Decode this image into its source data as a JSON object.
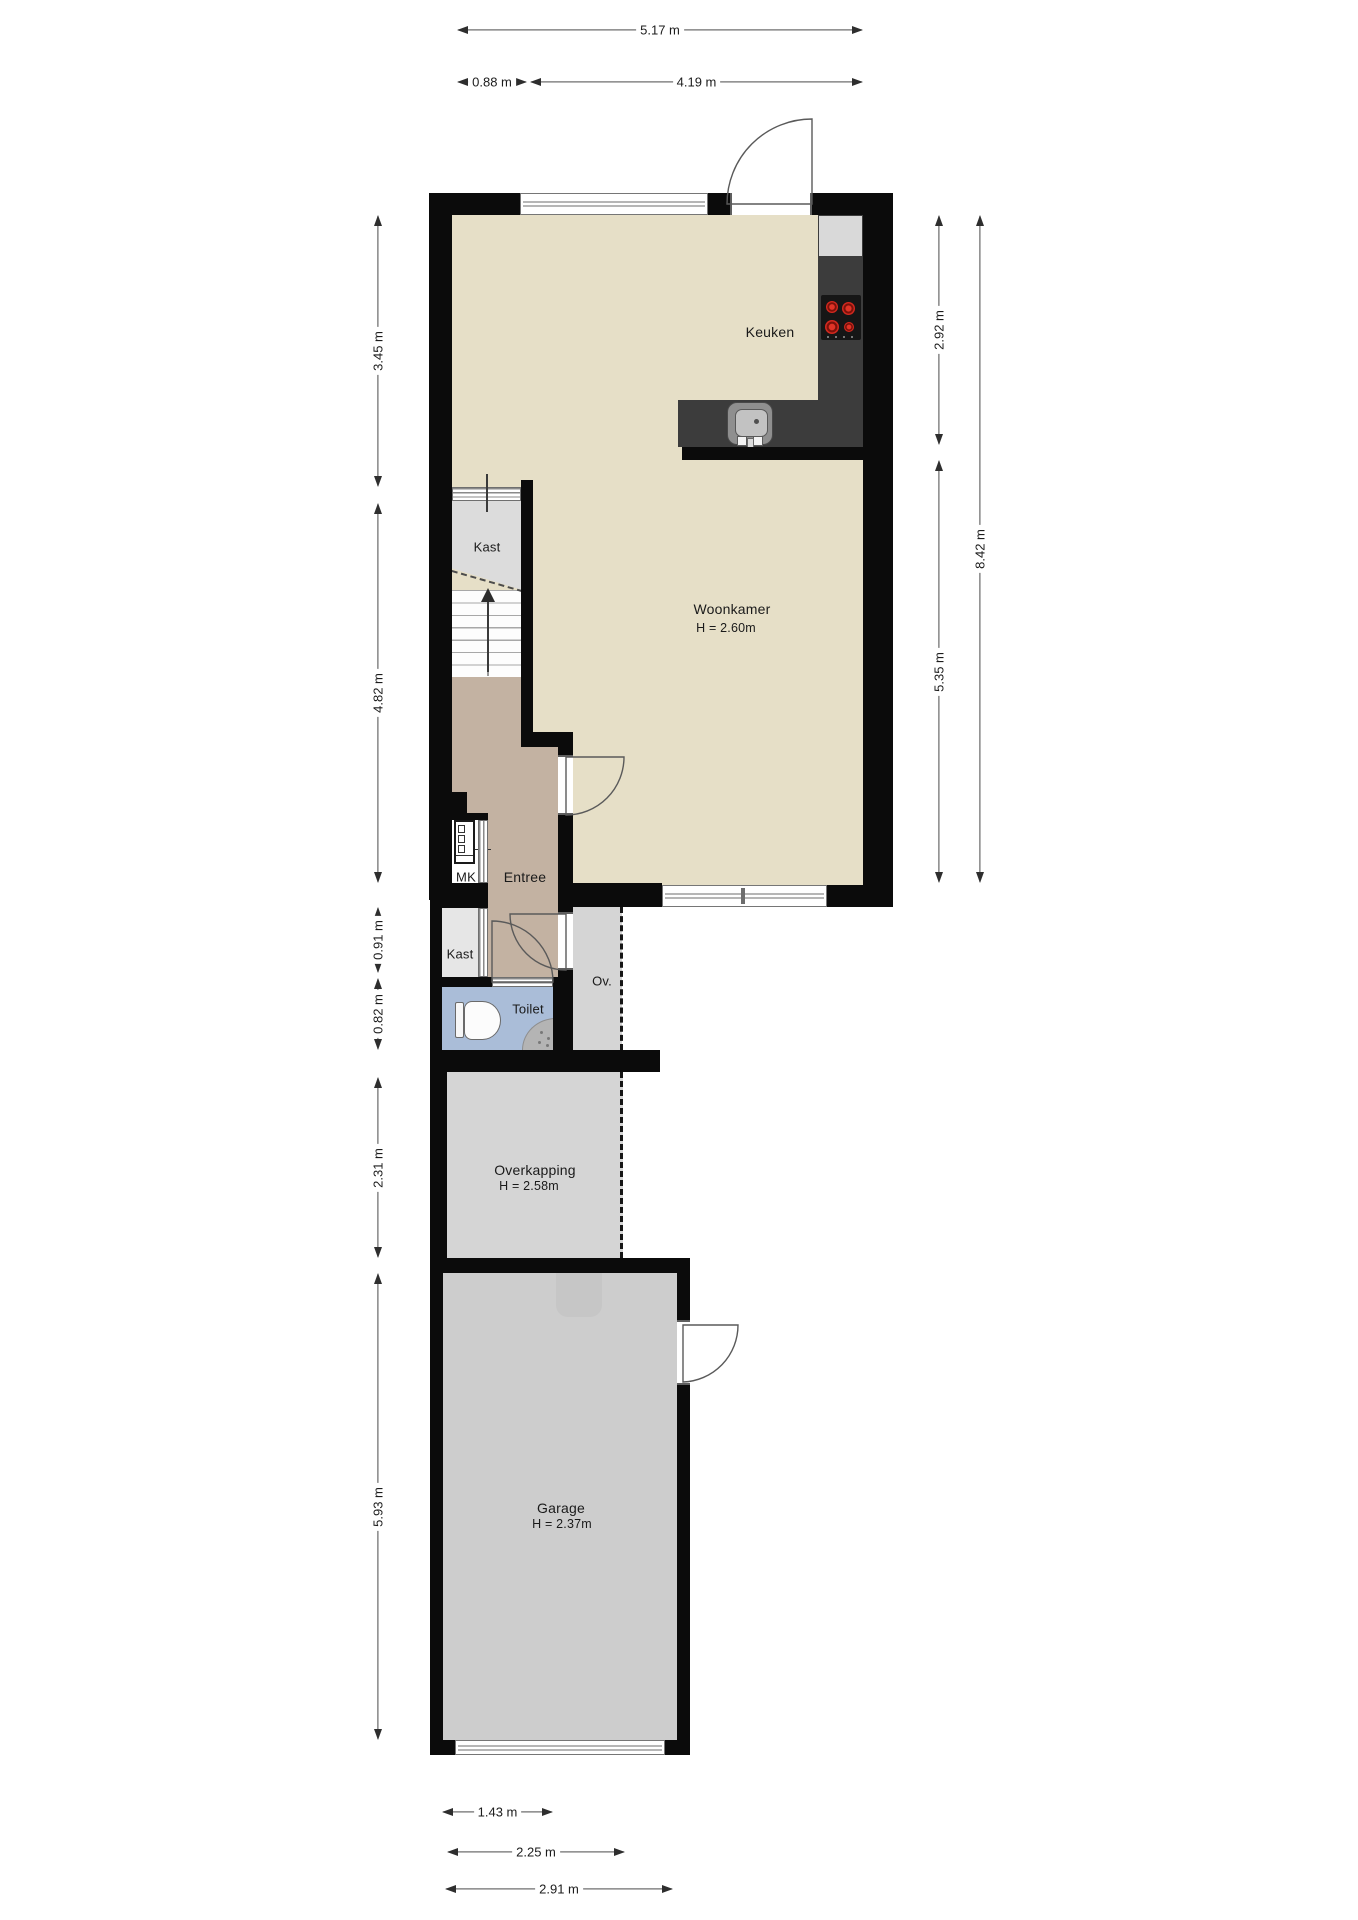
{
  "plan": {
    "type": "floor-plan",
    "language": "nl"
  },
  "rooms": {
    "keuken": {
      "label": "Keuken"
    },
    "woonkamer": {
      "label": "Woonkamer",
      "height_label": "H = 2.60m"
    },
    "kast_boven": {
      "label": "Kast"
    },
    "entree": {
      "label": "Entree"
    },
    "meterkast": {
      "label": "MK"
    },
    "kast_hal": {
      "label": "Kast"
    },
    "toilet": {
      "label": "Toilet"
    },
    "ov": {
      "label": "Ov."
    },
    "overkapping": {
      "label": "Overkapping",
      "height_label": "H = 2.58m"
    },
    "garage": {
      "label": "Garage",
      "height_label": "H = 2.37m"
    }
  },
  "dims": {
    "top": [
      {
        "label": "5.17 m"
      },
      {
        "label": "0.88 m"
      },
      {
        "label": "4.19 m"
      }
    ],
    "left": [
      {
        "label": "3.45 m"
      },
      {
        "label": "4.82 m"
      },
      {
        "label": "0.91 m"
      },
      {
        "label": "0.82 m"
      },
      {
        "label": "2.31 m"
      },
      {
        "label": "5.93 m"
      }
    ],
    "right": [
      {
        "label": "2.92 m"
      },
      {
        "label": "8.42 m"
      },
      {
        "label": "5.35 m"
      }
    ],
    "bottom": [
      {
        "label": "1.43 m"
      },
      {
        "label": "2.25 m"
      },
      {
        "label": "2.91 m"
      }
    ]
  },
  "icons": {
    "stove": "stove-icon",
    "sink": "sink-icon",
    "toilet": "toilet-icon",
    "shower": "shower-icon",
    "stairs": "stairs-up-arrow-icon",
    "meter_cabinet": "meter-cabinet-icon",
    "garage_door": "garage-door-icon",
    "door_swing": "door-swing-arc-icon"
  },
  "colors": {
    "wall": "#0b0b0b",
    "floor_living": "#e6dfc7",
    "floor_hall": "#c3b2a2",
    "floor_closet": "#dcdcdc",
    "floor_toilet": "#aabdd8",
    "floor_outdoor": "#d5d5d5",
    "floor_garage": "#cdcdcd",
    "counter": "#3c3c3c",
    "burner_red": "#c4261d"
  }
}
